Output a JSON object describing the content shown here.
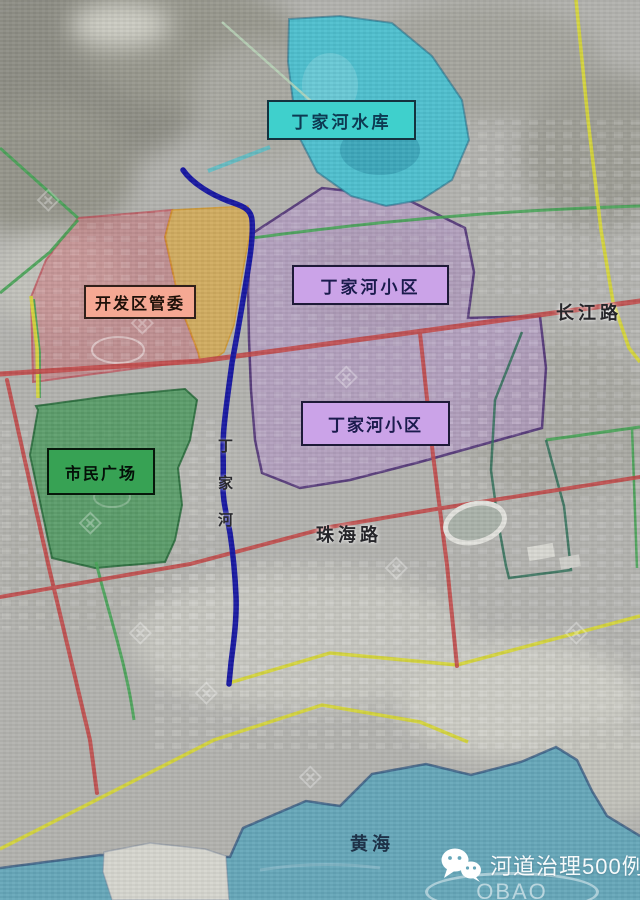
{
  "map": {
    "title_labels": {
      "reservoir": "丁家河水库",
      "dev_zone": "开发区管委",
      "estate_upper": "丁家河小区",
      "estate_lower": "丁家河小区",
      "plaza": "市民广场"
    },
    "road_labels": {
      "changjiang": "长江路",
      "zhuhai": "珠海路"
    },
    "river_label": {
      "c1": "丁",
      "c2": "家",
      "c3": "河"
    },
    "sea_label": "黄海",
    "watermark": {
      "title": "河道治理500例",
      "oval_text": "OBAO",
      "icon": "wechat-icon",
      "tile_glyph": "⊞"
    },
    "colors": {
      "reservoir_fill": "#4FC0CF",
      "reservoir_label_bg": "#3FD0CC",
      "sea_fill": "#66A7BA",
      "river": "#1818A2",
      "dev_zone_fill": "#CB7076",
      "dev_zone_label_bg": "#F5A893",
      "wedge_fill": "#E4A830",
      "estate_fill": "#B28ECD",
      "estate_label_bg": "#CBA3E8",
      "plaza_fill": "#379450",
      "plaza_label_bg": "#37A254",
      "road_red": "#C24848",
      "road_yellow": "#D6D63A",
      "road_green": "#47A356"
    }
  }
}
